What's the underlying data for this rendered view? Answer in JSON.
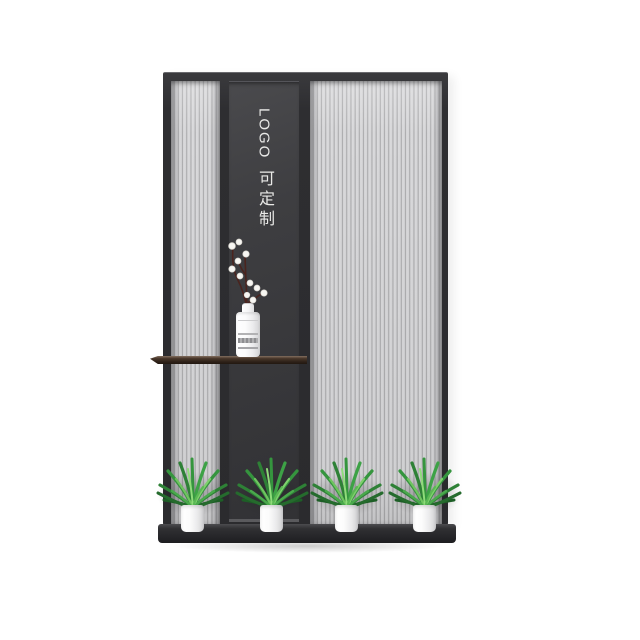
{
  "partition": {
    "logo_text": "LOGO",
    "custom_text": "可定制",
    "text_color": "#e9e9e7",
    "frame_color": "#2e2e31",
    "flute_light_color": "#d7d7d9",
    "flute_groove_color": "#a2a2a4",
    "center_panel_color": "#3c3c3f",
    "base_color": "#252528"
  },
  "decor": {
    "shelf_wood_color": "#3a2b20",
    "vase_color": "#f5f5f6",
    "cotton_blossom_color": "#f7f6f2",
    "cotton_stem_color": "#4a241e",
    "plant_count": 4,
    "pot_color": "#f6f6f7",
    "leaf_colors": [
      "#1d5e26",
      "#2e8136",
      "#35953e",
      "#7ed06c"
    ]
  }
}
